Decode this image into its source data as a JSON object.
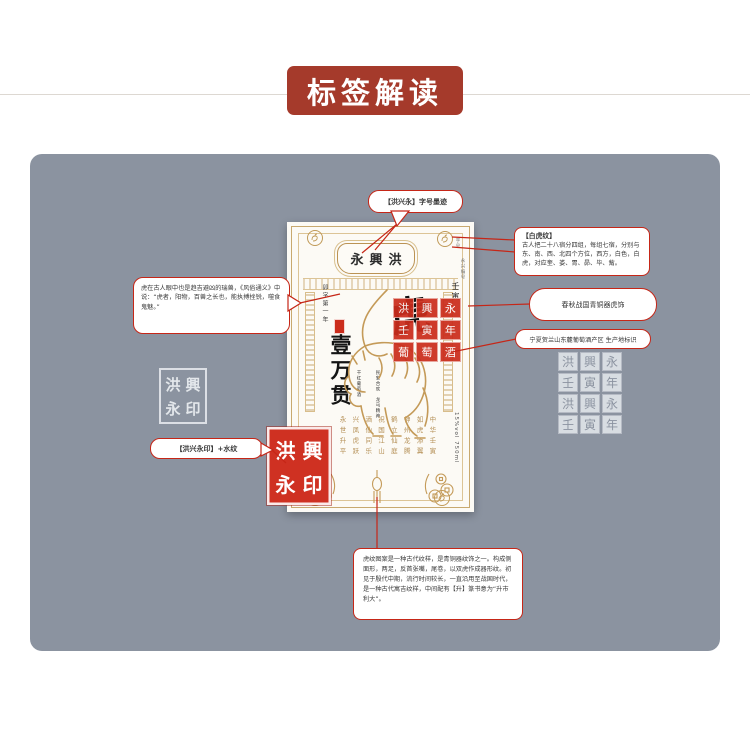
{
  "colors": {
    "banner_bg": "#a53a2b",
    "panel_bg": "#8b93a0",
    "callout_red": "#c62617",
    "gold": "#c09a58",
    "seal_red": "#cb2d1c"
  },
  "icons": {
    "corner_medallion": "rooster-medallion",
    "bottom_left_decor": "coin-string",
    "bottom_right_decor": "coin-string",
    "bottom_center_decor": "gourd-pendant",
    "center_art": "tiger-line-art"
  },
  "banner": {
    "title": "标签解读"
  },
  "label": {
    "brand": "永興洪",
    "date_column": "卯字第一年",
    "calligraphy": "壹万贯",
    "zodiac_year": "壬寅",
    "tiger_char": "虎",
    "volume": "15%vol 750ml",
    "corner_note_a": "字号",
    "corner_note_b": "永兴编号",
    "micro_columns": [
      "民安合欢",
      "龙马精神",
      "干红葡萄酒"
    ],
    "poem_columns": [
      "永世升平",
      "兴凤虎跃",
      "酒仙同乐",
      "祝国江山",
      "鹤立仙庭",
      "神州龙腾",
      "如虎添翼",
      "中华壬寅"
    ]
  },
  "seals": {
    "main_chars": [
      "洪",
      "興",
      "永",
      "印"
    ],
    "grid_chars": [
      "洪",
      "興",
      "永",
      "壬",
      "寅",
      "年",
      "葡",
      "萄",
      "酒"
    ],
    "gray_chars": [
      "洪",
      "興",
      "永",
      "壬",
      "寅",
      "年"
    ]
  },
  "callouts": {
    "top_bubble": {
      "text": "【洪兴永】字号墨迹"
    },
    "white_tiger": {
      "title": "【白虎纹】",
      "body": "古人把二十八宿分四组，每组七宿，分别与东、南、西、北四个方位，西方，白色，白虎，对应奎、娄、胃、昴、毕、觜。"
    },
    "bronze": {
      "text": "春秋战国青铜器虎饰"
    },
    "region": {
      "text": "宁夏贺兰山东麓葡萄酒产区 生产地标识"
    },
    "tiger_lore": {
      "text": "虎在古人眼中也是趋吉避凶的瑞兽，《风俗通义》中说：“虎者，阳物，百兽之长也，能执搏挫锐，噬食鬼魅。”"
    },
    "seal_note": {
      "text": "【洪兴永印】+水纹"
    },
    "pattern_note": {
      "text": "虎纹图案是一种古代纹样，是青铜器纹饰之一。构成侧面形，两足，反首张嘴，尾卷，以双虎作成器形纹。初见于殷代中期，流行时间较长，一直沿用至战国时代，是一种古代寓吉纹样，中间配有【升】篆书意为“升市利大”。"
    }
  }
}
